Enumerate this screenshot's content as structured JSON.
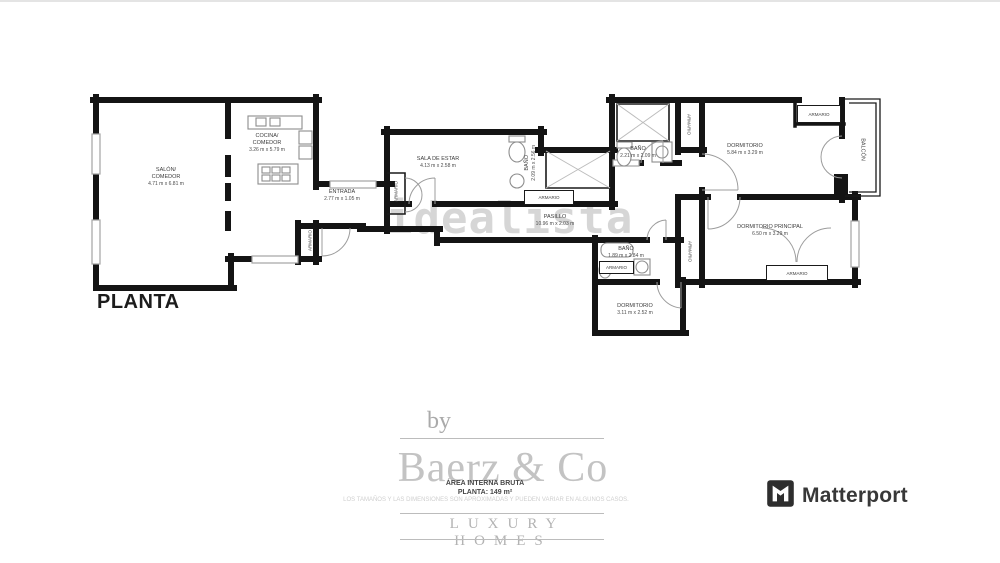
{
  "page": {
    "title": "PLANTA",
    "watermark": "idealista"
  },
  "closet_label": "ARMARIO",
  "rooms": [
    {
      "name": "SALÓN/\nCOMEDOR",
      "dims": "4.71 m x 6.81 m"
    },
    {
      "name": "COCINA/\nCOMEDOR",
      "dims": "3.26 m x 5.79 m"
    },
    {
      "name": "ENTRADA",
      "dims": "2.77 m x 1.05 m"
    },
    {
      "name": "SALA DE ESTAR",
      "dims": "4.13 m x 2.58 m"
    },
    {
      "name": "BAÑO",
      "dims": "2.09 m x 2.56 m"
    },
    {
      "name": "PASILLO",
      "dims": "10.96 m x 2.03 m"
    },
    {
      "name": "BAÑO",
      "dims": "2.21 m x 2.09 m"
    },
    {
      "name": "DORMITORIO",
      "dims": "5.84 m x 3.29 m"
    },
    {
      "name": "BALCÓN",
      "dims": ""
    },
    {
      "name": "DORMITORIO PRINCIPAL",
      "dims": "6.50 m x 3.29 m"
    },
    {
      "name": "BAÑO",
      "dims": "1.89 m x 2.84 m"
    },
    {
      "name": "DORMITORIO",
      "dims": "3.11 m x 2.52 m"
    }
  ],
  "footer": {
    "by": "by",
    "brand": "Baerz & Co",
    "tagline": "LUXURY HOMES",
    "disclaimer": "LOS TAMAÑOS Y LAS DIMENSIONES SON APROXIMADAS Y PUEDEN VARIAR EN ALGUNOS CASOS.",
    "area_label": "ÁREA INTERNA BRUTA",
    "area_value": "PLANTA: 149 m²"
  },
  "matterport_label": "Matterport",
  "colors": {
    "wall": "#141414",
    "watermark": "#d6d6d6",
    "brand_gray": "#c3c3c3",
    "logo_dark": "#383838"
  }
}
